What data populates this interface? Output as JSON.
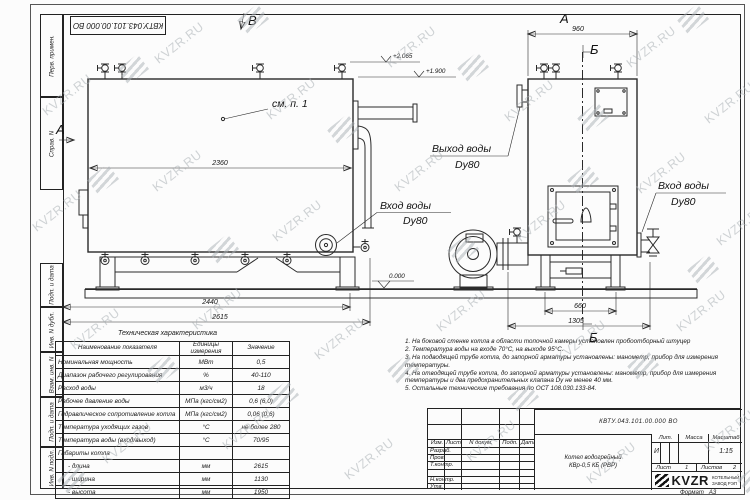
{
  "watermark": {
    "text": "KVZR.RU"
  },
  "stamp_top": "КВТУ.043.101.00.000 ВО",
  "sidebar": [
    "Перв. примен.",
    "Справ. N",
    "Подп. и дата",
    "Инв. N дубл.",
    "Взам. инв. N",
    "Подп. и дата",
    "Инв. N подл."
  ],
  "drawing": {
    "see_note": "см. п. 1",
    "inlet1": "Вход воды",
    "inlet1_dn": "Dy80",
    "outlet": "Выход воды",
    "outlet_dn": "Dy80",
    "inlet2": "Вход воды",
    "inlet2_dn": "Dy80",
    "marker_a": "А",
    "marker_b": "Б",
    "marker_v": "В",
    "lvl_2065": "+2.065",
    "lvl_1900": "+1.900",
    "lvl_0": "0.000",
    "dim_2360": "2360",
    "dim_2440": "2440",
    "dim_2615": "2615",
    "dim_960": "960",
    "dim_660": "660",
    "dim_1305": "1305"
  },
  "tech_table": {
    "title": "Техническая характеристика",
    "headers": [
      "Наименование показателя",
      "Единицы измерения",
      "Значение"
    ],
    "rows": [
      [
        "Номинальная мощность",
        "МВт",
        "0,5"
      ],
      [
        "Диапазон рабочего регулирования",
        "%",
        "40-110"
      ],
      [
        "Расход воды",
        "м3/ч",
        "18"
      ],
      [
        "Рабочее давление воды",
        "МПа (кгс/см2)",
        "0,6 (6,0)"
      ],
      [
        "Гидравлическое сопротивление котла",
        "МПа (кгс/см2)",
        "0,06 (0,6)"
      ],
      [
        "Температура уходящих газов",
        "°С",
        "не более 280"
      ],
      [
        "Температура воды (вход/выход)",
        "°С",
        "70/95"
      ],
      [
        "Габариты котла",
        "",
        ""
      ],
      [
        "- длина",
        "мм",
        "2615"
      ],
      [
        "- ширина",
        "мм",
        "1130"
      ],
      [
        "- высота",
        "мм",
        "1950"
      ]
    ]
  },
  "notes": [
    "1. На боковой стенке котла в области топочной камеры установлен пробоотборный штуцер",
    "2. Температура воды на входе 70°С, на выходе 95°С.",
    "3. На подводящей трубе котла, до запорной арматуры установлены: манометр, прибор для измерения температуры.",
    "4. На отводящей трубе котла, до запорной арматуры установлены: манометр, прибор для измерения температуры и два предохранительных клапана Dу не менее 40 мм.",
    "5. Остальные технические требования по ОСТ 108.030.133-84."
  ],
  "title_block": {
    "doc_number": "КВТУ.043.101.00.000 ВО",
    "name_line1": "Котел водогрейный",
    "name_line2": "КВр-0,5 КБ (РВР)",
    "hdr_izm": "Изм.",
    "hdr_list": "Лист",
    "hdr_ndoc": "N докум.",
    "hdr_podp": "Подп.",
    "hdr_data": "Дата",
    "row_razrab": "Разраб.",
    "row_prov": "Пров.",
    "row_tkontr": "Т.контр.",
    "row_nkontr": "Н.контр.",
    "row_utv": "Утв.",
    "lit_label": "Лит.",
    "lit_value": "И",
    "mass_label": "Масса",
    "scale_label": "Масштаб",
    "scale_value": "1:15",
    "sheet_label": "Лист",
    "sheet_value": "1",
    "sheets_label": "Листов",
    "sheets_value": "2",
    "logo_text": "KVZR",
    "logo_sub1": "КОТЕЛЬНЫЙ",
    "logo_sub2": "ЗАВОД РЭП",
    "format_label": "Формат",
    "format_value": "А3"
  }
}
